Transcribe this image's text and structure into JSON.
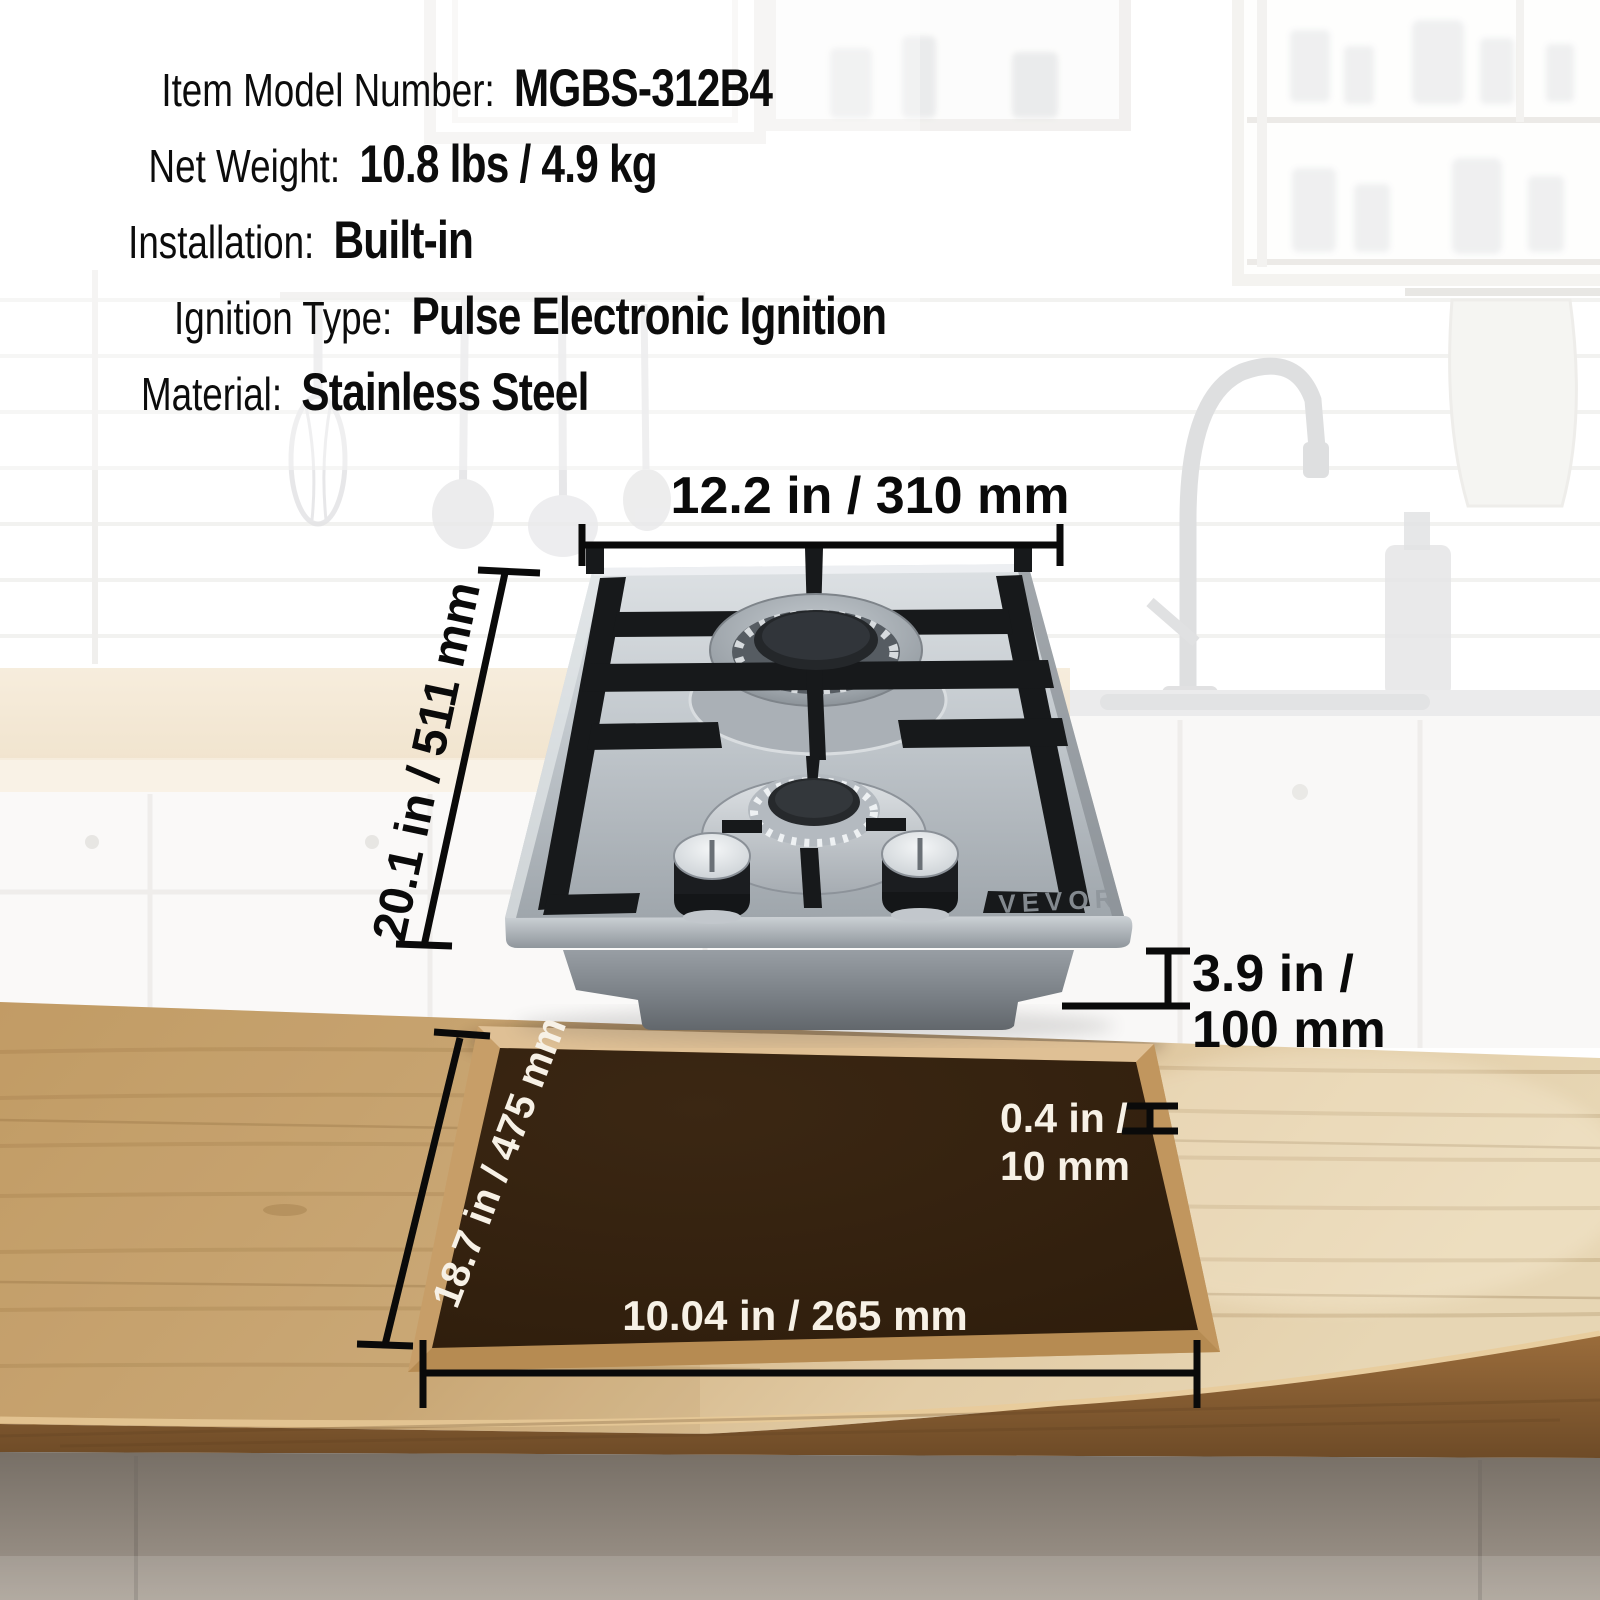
{
  "specs": {
    "rows": [
      {
        "label": "Item Model Number:",
        "value": "MGBS-312B4"
      },
      {
        "label": "Net Weight:",
        "value": "10.8 lbs / 4.9 kg"
      },
      {
        "label": "Installation:",
        "value": "Built-in"
      },
      {
        "label": "Ignition Type:",
        "value": "Pulse Electronic Ignition"
      },
      {
        "label": "Material:",
        "value": "Stainless Steel"
      }
    ]
  },
  "dimensions": {
    "top_width": "12.2 in / 310 mm",
    "depth": "20.1 in / 511 mm",
    "height_line1": "3.9 in /",
    "height_line2": "100 mm",
    "cutout_depth": "18.7 in / 475 mm",
    "cutout_width": "10.04 in / 265 mm",
    "thickness_line1": "0.4 in /",
    "thickness_line2": "10 mm"
  },
  "product": {
    "brand": "VEVOR"
  },
  "colors": {
    "annotation_dark": "#0a0a0a",
    "annotation_light": "#f7f1e6",
    "countertop_wood": "#cfae7d",
    "cutout_dark": "#34220f",
    "steel": "#b3b9bf"
  }
}
